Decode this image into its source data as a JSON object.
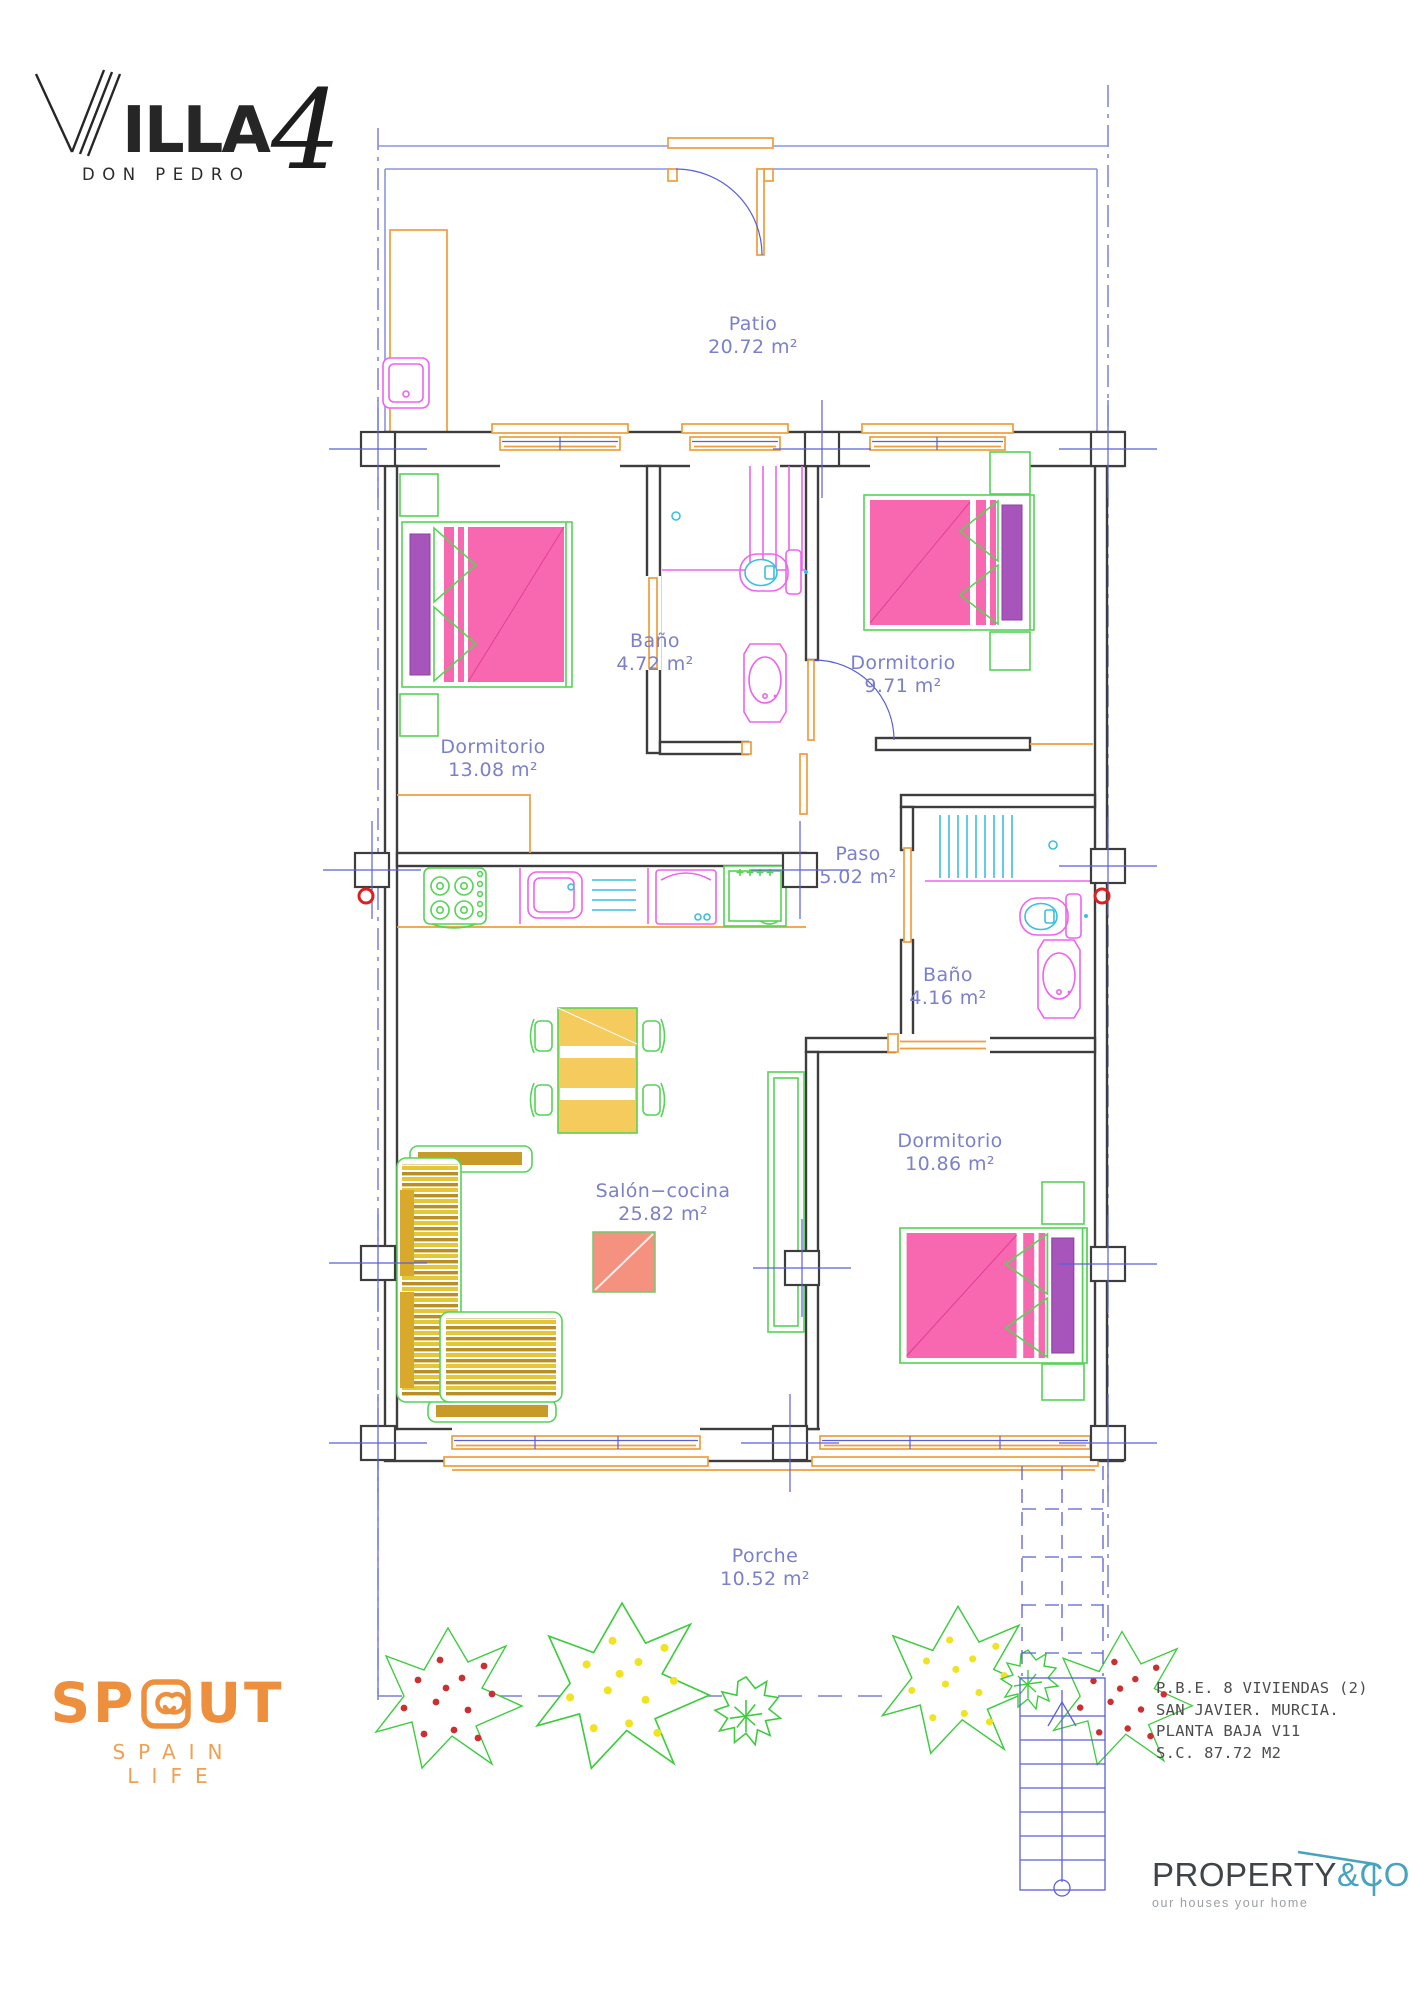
{
  "header": {
    "logo_initial": "V",
    "logo_rest": "ILLA",
    "logo_number": "4",
    "subtitle": "DON PEDRO"
  },
  "rooms": [
    {
      "id": "patio",
      "name": "Patio",
      "area": "20.72 m²"
    },
    {
      "id": "dormitorio-1",
      "name": "Dormitorio",
      "area": "13.08 m²"
    },
    {
      "id": "bano-1",
      "name": "Baño",
      "area": "4.72 m²"
    },
    {
      "id": "dormitorio-2",
      "name": "Dormitorio",
      "area": "9.71 m²"
    },
    {
      "id": "paso",
      "name": "Paso",
      "area": "5.02 m²"
    },
    {
      "id": "bano-2",
      "name": "Baño",
      "area": "4.16 m²"
    },
    {
      "id": "dormitorio-3",
      "name": "Dormitorio",
      "area": "10.86 m²"
    },
    {
      "id": "salon-cocina",
      "name": "Salón−cocina",
      "area": "25.82 m²"
    },
    {
      "id": "porche",
      "name": "Porche",
      "area": "10.52 m²"
    }
  ],
  "project_info": {
    "line1": "P.B.E. 8 VIVIENDAS (2)",
    "line2": "SAN JAVIER. MURCIA.",
    "line3": "PLANTA BAJA V11",
    "line4": "S.C. 87.72 M2"
  },
  "footer_left": {
    "logo_text": "SPOUT",
    "logo_left": "SP",
    "logo_right": "UT",
    "tagline": "SPAIN LIFE"
  },
  "footer_right": {
    "brand_primary": "PROPERTY",
    "brand_secondary": "&CO",
    "tagline": "our houses your home"
  },
  "colors": {
    "wall": "#3d3d3d",
    "patio_wall": "#8e94e0",
    "axis_blue": "#5b5fd6",
    "accent_orange": "#f09d3c",
    "fixture_magenta": "#ee63ee",
    "fixture_cyan": "#3bbfdf",
    "furniture_green": "#55d455",
    "bed_pink": "#f768b0",
    "pillow_purple": "#a855bb",
    "sofa_yellow": "#e4c735",
    "coral": "#f5917f",
    "label_blue": "#7b80c8",
    "marker_red": "#dd1f1f",
    "plant_green": "#3ecc3e",
    "plant_red": "#cc2f2f",
    "plant_yellow": "#f0e322",
    "logo_orange": "#ee8f3e",
    "brand_dark": "#3f4448",
    "brand_teal": "#48a3be"
  }
}
